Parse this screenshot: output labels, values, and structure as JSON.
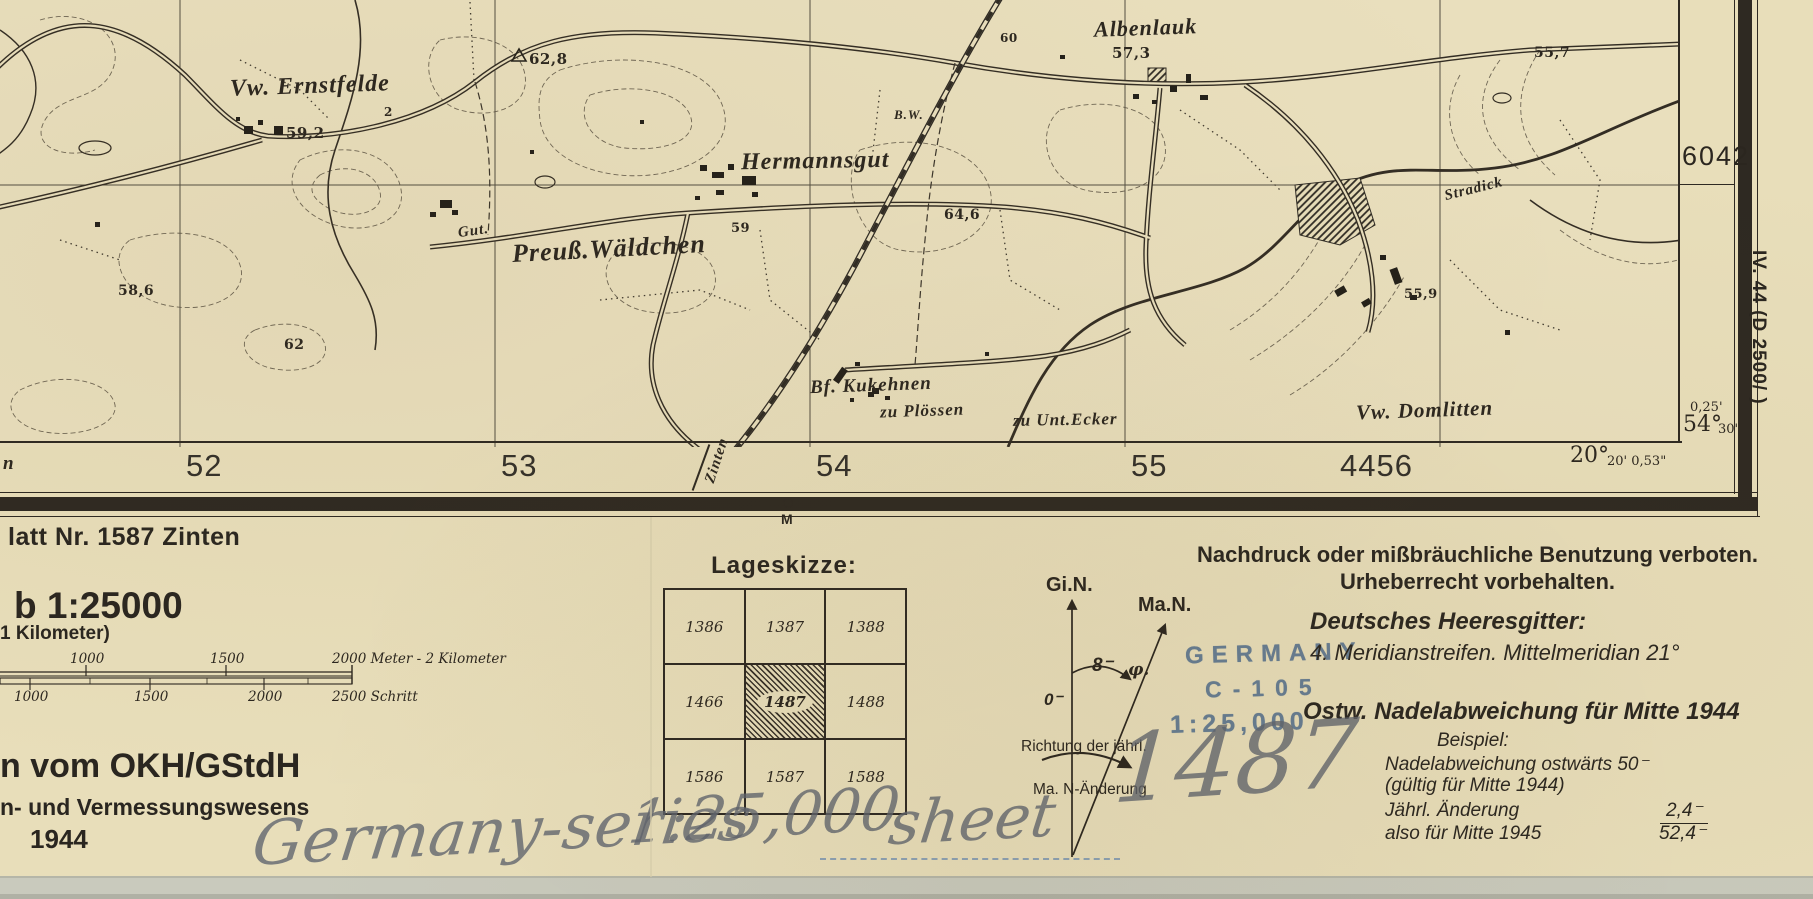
{
  "paper_color": "#e8deba",
  "ink_color": "#2e2922",
  "stamp_color": "#5b7590",
  "pencil_color": "#5f646e",
  "map": {
    "labels": [
      {
        "t": "Vw. Ernstfelde",
        "x": 230,
        "y": 74,
        "s": 24,
        "r": -2
      },
      {
        "t": "Hermannsgut",
        "x": 741,
        "y": 149,
        "s": 24,
        "r": -1
      },
      {
        "t": "Gut.",
        "x": 458,
        "y": 224,
        "s": 15,
        "r": -8
      },
      {
        "t": "Preuß.Wäldchen",
        "x": 512,
        "y": 236,
        "s": 26,
        "r": -3
      },
      {
        "t": "Bf. Kukehnen",
        "x": 810,
        "y": 376,
        "s": 19,
        "r": -2
      },
      {
        "t": "zu Plössen",
        "x": 880,
        "y": 402,
        "s": 17,
        "r": -2
      },
      {
        "t": "zu Unt.Ecker",
        "x": 1013,
        "y": 411,
        "s": 17,
        "r": -1
      },
      {
        "t": "Vw. Domlitten",
        "x": 1356,
        "y": 400,
        "s": 21,
        "r": -2
      },
      {
        "t": "Albenlauk",
        "x": 1094,
        "y": 17,
        "s": 22,
        "r": -2
      },
      {
        "t": "Stradick",
        "x": 1444,
        "y": 182,
        "s": 15,
        "r": -14
      },
      {
        "t": "B.W.",
        "x": 894,
        "y": 108,
        "s": 13,
        "r": 0
      }
    ],
    "spots": [
      {
        "t": "59,2",
        "x": 286,
        "y": 126,
        "s": 15
      },
      {
        "t": "62,8",
        "x": 529,
        "y": 52,
        "s": 15
      },
      {
        "t": "57,3",
        "x": 1112,
        "y": 46,
        "s": 15
      },
      {
        "t": "55,7",
        "x": 1534,
        "y": 46,
        "s": 14
      },
      {
        "t": "64,6",
        "x": 944,
        "y": 208,
        "s": 14
      },
      {
        "t": "58,6",
        "x": 118,
        "y": 284,
        "s": 14
      },
      {
        "t": "62",
        "x": 284,
        "y": 338,
        "s": 14
      },
      {
        "t": "55,9",
        "x": 1404,
        "y": 288,
        "s": 13
      },
      {
        "t": "60",
        "x": 1000,
        "y": 32,
        "s": 12
      },
      {
        "t": "59",
        "x": 731,
        "y": 222,
        "s": 13
      },
      {
        "t": "2",
        "x": 384,
        "y": 106,
        "s": 12
      }
    ]
  },
  "frame": {
    "grid_numbers": [
      {
        "t": "52",
        "x": 186
      },
      {
        "t": "53",
        "x": 501
      },
      {
        "t": "54",
        "x": 816
      },
      {
        "t": "55",
        "x": 1131
      },
      {
        "t": "4456",
        "x": 1340
      }
    ],
    "northing_label": "6042",
    "left_edge_fragment": "n",
    "road_destination": "Zinten",
    "marker_label": "M",
    "corner_minutes": "0,25'",
    "lat_deg": "54°",
    "lat_min": "30'",
    "lon_deg": "20°",
    "lon_min": "20' 0,53\"",
    "margin_note_vertical": "IV. 44 (D 2500/  )"
  },
  "legend": {
    "sheet_note": "latt Nr. 1587 Zinten",
    "scale_heading": "b 1:25000",
    "kilometer_note": "1 Kilometer)",
    "scale_top": [
      "1000",
      "1500",
      "2000 Meter - 2 Kilometer"
    ],
    "scale_bottom": [
      "1000",
      "1500",
      "2000",
      "2500 Schritt"
    ],
    "publisher": "n vom OKH/GStdH",
    "department": "n- und Vermessungswesens",
    "year": "1944"
  },
  "lageskizze": {
    "title": "Lageskizze:",
    "cells": [
      [
        "1386",
        "1387",
        "1388"
      ],
      [
        "1466",
        "1487",
        "1488"
      ],
      [
        "1586",
        "1587",
        "1588"
      ]
    ],
    "highlighted": "1487"
  },
  "declination": {
    "grid_north": "Gi.N.",
    "magnetic_north": "Ma.N.",
    "angle_value": "8⁻",
    "angle_phi": "φ.",
    "zero": "0⁻",
    "annual_line1": "Richtung der jährl.",
    "annual_line2": "Ma. N-Änderung"
  },
  "stamp": {
    "line1": "GERMANY",
    "line2": "C-105",
    "line3": "1:25,000"
  },
  "rights": {
    "line1": "Nachdruck oder mißbräuchliche Benutzung verboten.",
    "line2": "Urheberrecht vorbehalten.",
    "grid_title": "Deutsches Heeresgitter:",
    "grid_line": "4. Meridianstreifen. Mittelmeridian 21°",
    "declination_title": "Ostw. Nadelabweichung für Mitte 1944",
    "example_label": "Beispiel:",
    "example_line1": "Nadelabweichung ostwärts 50⁻",
    "example_line2": "(gültig für Mitte 1944)",
    "annual_label": "Jährl. Änderung",
    "annual_value": "2,4⁻",
    "mid1945_label": "also für Mitte 1945",
    "mid1945_value": "52,4⁻"
  },
  "handwriting": {
    "part1": "Germany-series",
    "part2": "1:25,000",
    "part3": "sheet",
    "part4": "1487"
  }
}
